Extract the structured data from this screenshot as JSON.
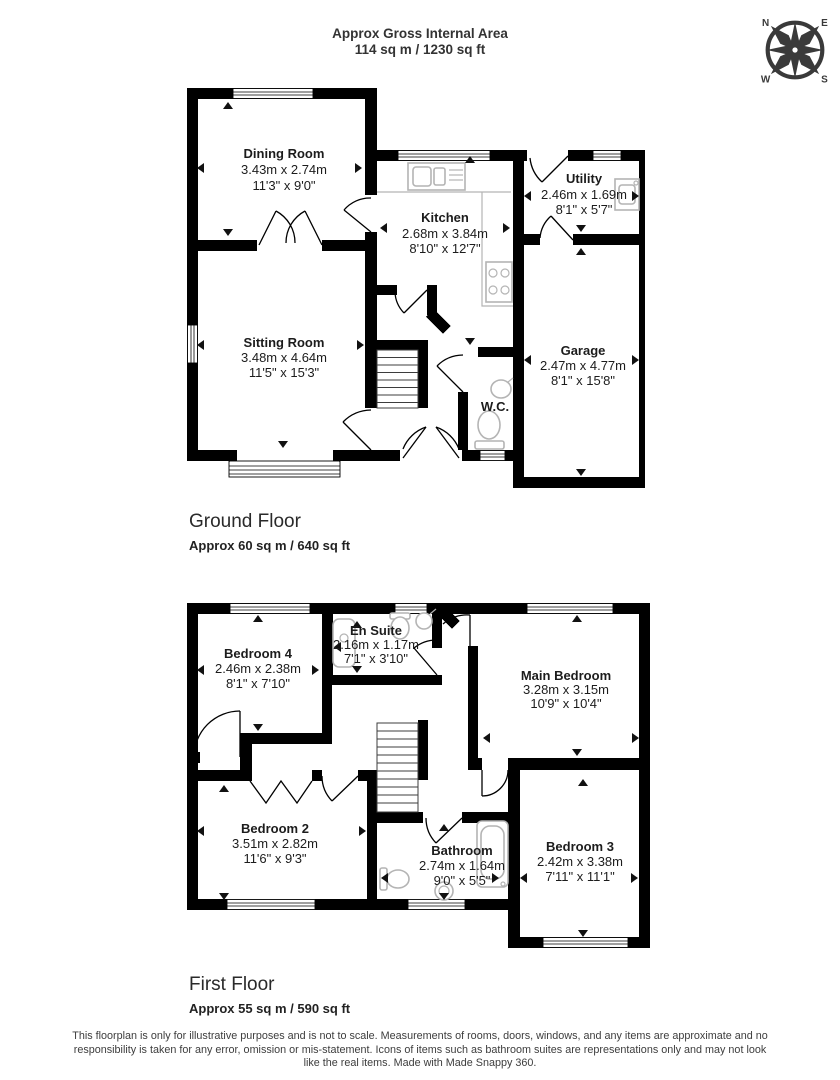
{
  "header": {
    "title": "Approx Gross Internal Area",
    "subtitle": "114 sq m / 1230 sq ft"
  },
  "compass": {
    "north": "N",
    "east": "E",
    "south": "S",
    "west": "W"
  },
  "ground_floor": {
    "name": "Ground Floor",
    "area": "Approx 60 sq m / 640 sq ft",
    "rooms": {
      "dining": {
        "name": "Dining Room",
        "metric": "3.43m x 2.74m",
        "imperial": "11'3\" x 9'0\""
      },
      "kitchen": {
        "name": "Kitchen",
        "metric": "2.68m x 3.84m",
        "imperial": "8'10\" x 12'7\""
      },
      "utility": {
        "name": "Utility",
        "metric": "2.46m x 1.69m",
        "imperial": "8'1\" x 5'7\""
      },
      "sitting": {
        "name": "Sitting Room",
        "metric": "3.48m x 4.64m",
        "imperial": "11'5\" x 15'3\""
      },
      "garage": {
        "name": "Garage",
        "metric": "2.47m x 4.77m",
        "imperial": "8'1\" x 15'8\""
      },
      "wc": {
        "name": "W.C."
      }
    }
  },
  "first_floor": {
    "name": "First Floor",
    "area": "Approx 55 sq m / 590 sq ft",
    "rooms": {
      "bedroom4": {
        "name": "Bedroom 4",
        "metric": "2.46m x 2.38m",
        "imperial": "8'1\" x 7'10\""
      },
      "ensuite": {
        "name": "En Suite",
        "metric": "2.16m x 1.17m",
        "imperial": "7'1\" x 3'10\""
      },
      "main_bedroom": {
        "name": "Main Bedroom",
        "metric": "3.28m x 3.15m",
        "imperial": "10'9\" x 10'4\""
      },
      "bedroom2": {
        "name": "Bedroom 2",
        "metric": "3.51m x 2.82m",
        "imperial": "11'6\" x 9'3\""
      },
      "bathroom": {
        "name": "Bathroom",
        "metric": "2.74m x 1.64m",
        "imperial": "9'0\" x 5'5\""
      },
      "bedroom3": {
        "name": "Bedroom 3",
        "metric": "2.42m x 3.38m",
        "imperial": "7'11\" x 11'1\""
      }
    }
  },
  "footer": {
    "disclaimer": "This floorplan is only for illustrative purposes and is not to scale. Measurements of rooms, doors, windows, and any items are approximate and no responsibility is taken for any error, omission or mis-statement. Icons of items such as bathroom suites are representations only and may not look like the real items. Made with Made Snappy 360."
  },
  "colors": {
    "wall": "#000000",
    "fixture": "#b4b4b4",
    "compass": "#3a3a3a"
  }
}
